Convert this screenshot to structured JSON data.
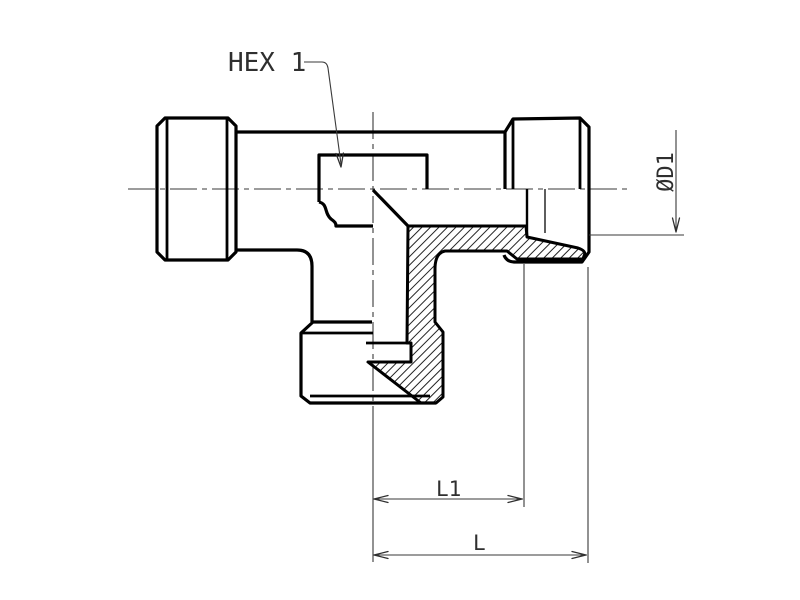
{
  "drawing": {
    "background_color": "#ffffff",
    "outline_color": "#000000",
    "dimension_line_color": "#3a3a3a",
    "text_color": "#2f2f2f",
    "labels": {
      "hex_callout": "HEX 1",
      "diameter_dim": "ØD1",
      "length1_dim": "L1",
      "overall_length_dim": "L"
    }
  }
}
